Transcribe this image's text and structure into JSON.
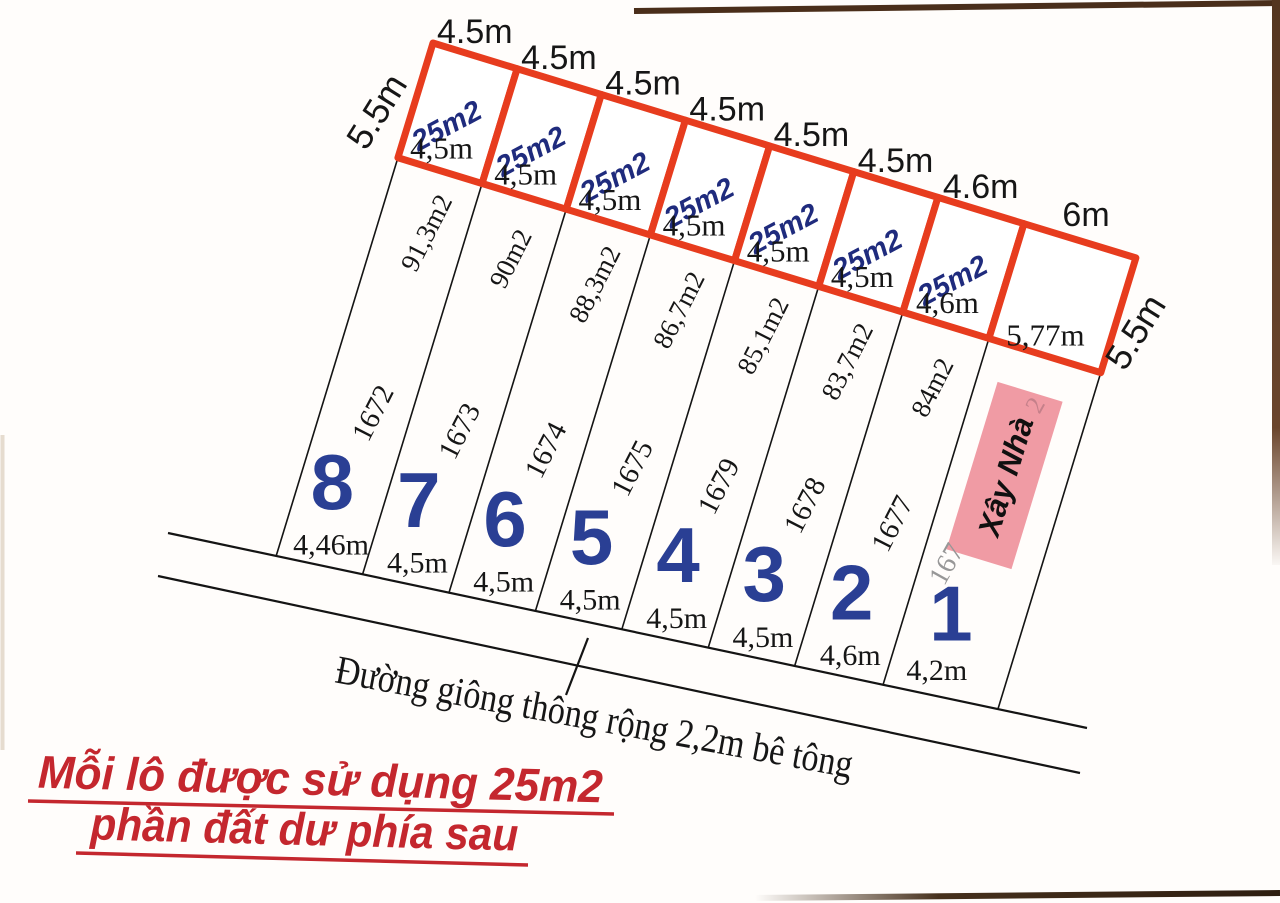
{
  "diagram": {
    "title_hint": "land subdivision sketch",
    "side_label_left": "5.5m",
    "side_label_right": "5.5m",
    "plots": [
      {
        "number": "8",
        "parcel_id": "1672",
        "area": "91,3m2",
        "frontage": "4,46m",
        "square_top": "4.5m",
        "square_bottom": "4,5m",
        "square_area": "25m2"
      },
      {
        "number": "7",
        "parcel_id": "1673",
        "area": "90m2",
        "frontage": "4,5m",
        "square_top": "4.5m",
        "square_bottom": "4,5m",
        "square_area": "25m2"
      },
      {
        "number": "6",
        "parcel_id": "1674",
        "area": "88,3m2",
        "frontage": "4,5m",
        "square_top": "4.5m",
        "square_bottom": "4,5m",
        "square_area": "25m2"
      },
      {
        "number": "5",
        "parcel_id": "1675",
        "area": "86,7m2",
        "frontage": "4,5m",
        "square_top": "4.5m",
        "square_bottom": "4,5m",
        "square_area": "25m2"
      },
      {
        "number": "4",
        "parcel_id": "1679",
        "area": "85,1m2",
        "frontage": "4,5m",
        "square_top": "4.5m",
        "square_bottom": "4,5m",
        "square_area": "25m2"
      },
      {
        "number": "3",
        "parcel_id": "1678",
        "area": "83,7m2",
        "frontage": "4,5m",
        "square_top": "4.5m",
        "square_bottom": "4,5m",
        "square_area": "25m2"
      },
      {
        "number": "2",
        "parcel_id": "1677",
        "area": "84m2",
        "frontage": "4,6m",
        "square_top": "4.6m",
        "square_bottom": "4,6m",
        "square_area": "25m2"
      },
      {
        "number": "1",
        "parcel_id": "",
        "area": "",
        "frontage": "4,2m",
        "square_top": "6m",
        "square_bottom": "5,77m",
        "square_area": ""
      }
    ],
    "build_house": {
      "label": "Xây Nhà",
      "faded_id": "167",
      "faded_area_fragment": "2"
    },
    "road": {
      "label": "Đường giông thông rộng 2,2m bê tông"
    },
    "note": {
      "line1": "Mỗi lô được sử dụng 25m2",
      "line2": "phần đất dư phía sau"
    },
    "colors": {
      "square_border_red": "#e73c1e",
      "square_area_navy": "#1f2b7d",
      "plot_number_blue": "#2a3f94",
      "build_house_pink": "#ef939c",
      "note_red": "#c4272e",
      "line_black": "#141414",
      "photo_edge_brown": "#4a2e1a"
    }
  }
}
